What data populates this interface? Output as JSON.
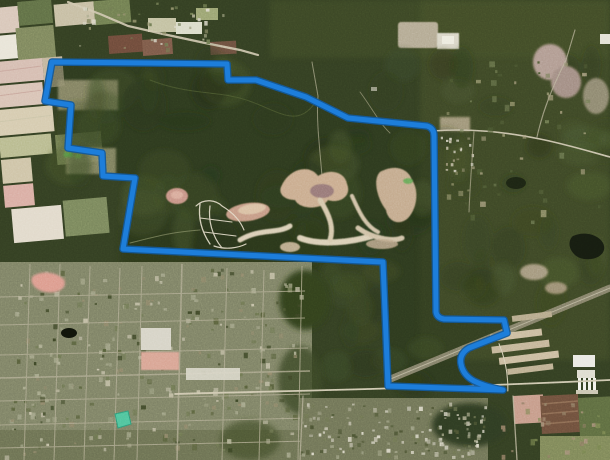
{
  "map": {
    "description": "Oblique aerial satellite view of a large forested tract outlined with a blue property-boundary polygon; farmland patchwork to the west, rural road with farms along the north, a sand-pit development in the center, an industrial facility and highway corridor to the southeast, suburban street grid to the southwest",
    "canvas": {
      "width": 610,
      "height": 460
    },
    "boundary": {
      "label": "property-boundary-polygon",
      "core_color": "#1d7edb",
      "edge_color": "#135a9c",
      "interior_tint": "#28341a",
      "path": "M52 62 L148 63 L227 64 L228 80 L256 80 L306 97 L348 118 L427 126 Q434 128 434 136 L436 312 Q437 318 444 319 L504 320 L507 333 L469 348 Q459 354 461 364 Q463 375 474 381 Q486 387 503 390 L388 386 L383 262 L123 249 L135 178 L103 176 L102 153 L68 148 L71 105 L45 101 Z"
    },
    "features": [
      {
        "name": "farmland-west",
        "color": "#d2c2ac"
      },
      {
        "name": "forest-interior",
        "color": "#2e3a1e"
      },
      {
        "name": "central-sand-development",
        "color": "#c9ab8d"
      },
      {
        "name": "suburban-grid-southwest",
        "color": "#7c8064"
      },
      {
        "name": "industrial-facility",
        "color": "#cabb9e"
      },
      {
        "name": "white-plant-silos",
        "color": "#e9e8e2"
      },
      {
        "name": "teal-pond",
        "color": "#4fc39b"
      },
      {
        "name": "dark-lake",
        "color": "#161c10"
      },
      {
        "name": "highway-corridor",
        "color": "#8f8a74"
      },
      {
        "name": "north-farm-road",
        "color": "#cfc6ae"
      }
    ]
  }
}
